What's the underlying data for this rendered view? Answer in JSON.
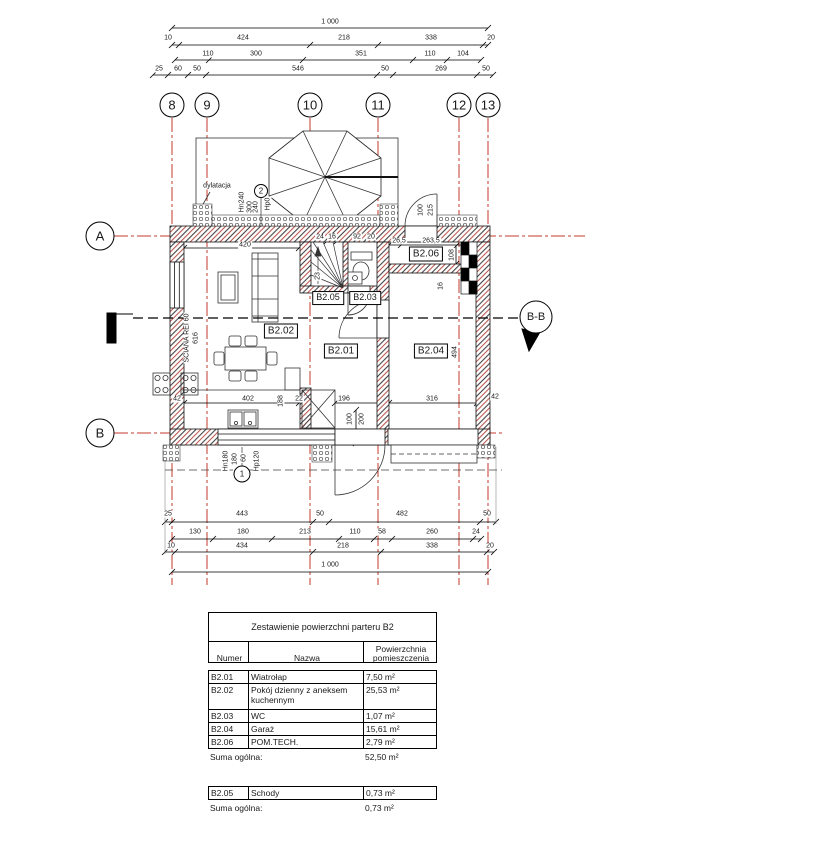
{
  "drawing": {
    "grid_cols": [
      "8",
      "9",
      "10",
      "11",
      "12",
      "13"
    ],
    "grid_rows": [
      "A",
      "B"
    ],
    "section_label": "B-B",
    "window_marks": {
      "top": "2",
      "bottom": "1"
    }
  },
  "top_dims": {
    "total": "1 000",
    "r2": [
      "10",
      "424",
      "218",
      "338",
      "20"
    ],
    "r3": [
      "110",
      "300",
      "351",
      "110",
      "104"
    ],
    "r4": [
      "25",
      "60",
      "50",
      "546",
      "50",
      "269",
      "50"
    ]
  },
  "bottom_dims": {
    "r1": [
      "25",
      "443",
      "50",
      "482",
      "50"
    ],
    "r2": [
      "130",
      "180",
      "213",
      "110",
      "58",
      "260",
      "24"
    ],
    "r3": [
      "10",
      "434",
      "218",
      "338",
      "20"
    ],
    "total": "1 000"
  },
  "plan": {
    "rooms": {
      "b201": "B2.01",
      "b202": "B2.02",
      "b203": "B2.03",
      "b204": "B2.04",
      "b205": "B2.05",
      "b206": "B2.06"
    },
    "dims": {
      "a420": "420",
      "a24": "24",
      "a16": "16",
      "a92": "92",
      "a20": "20",
      "a26": "26,5",
      "a263": "263,5",
      "a108": "108",
      "a16b": "16",
      "a100": "100",
      "a215": "215",
      "a494": "494",
      "a42l": "42",
      "a402": "402",
      "a188": "188",
      "a22": "22",
      "a196": "196",
      "a100b": "100",
      "a200": "200",
      "a316": "316",
      "a42r": "42",
      "a23": "23",
      "a616": "616"
    },
    "notes": {
      "dylatacja": "dylatacja",
      "sciana": "ŚCIANA REI 60",
      "hn240": "Hn240",
      "w300": "300",
      "w240": "240",
      "hp0": "Hp0",
      "hn180": "Hn180",
      "w180": "180",
      "w60": "60",
      "hp120": "Hp120"
    }
  },
  "area_table": {
    "title": "Zestawienie powierzchni parteru B2",
    "col_numer": "Numer",
    "col_nazwa": "Nazwa",
    "col_pow": "Powierzchnia pomieszczenia",
    "rows": [
      {
        "num": "B2.01",
        "name": "Wiatrołap",
        "area": "7,50 m²"
      },
      {
        "num": "B2.02",
        "name": "Pokój dzienny z aneksem kuchennym",
        "area": "25,53 m²"
      },
      {
        "num": "B2.03",
        "name": "WC",
        "area": "1,07 m²"
      },
      {
        "num": "B2.04",
        "name": "Garaż",
        "area": "15,61 m²"
      },
      {
        "num": "B2.06",
        "name": "POM.TECH.",
        "area": "2,79 m²"
      }
    ],
    "suma_label": "Suma ogólna:",
    "suma": "52,50 m²"
  },
  "stairs_table": {
    "rows": [
      {
        "num": "B2.05",
        "name": "Schody",
        "area": "0,73 m²"
      }
    ],
    "suma_label": "Suma ogólna:",
    "suma": "0,73 m²"
  }
}
